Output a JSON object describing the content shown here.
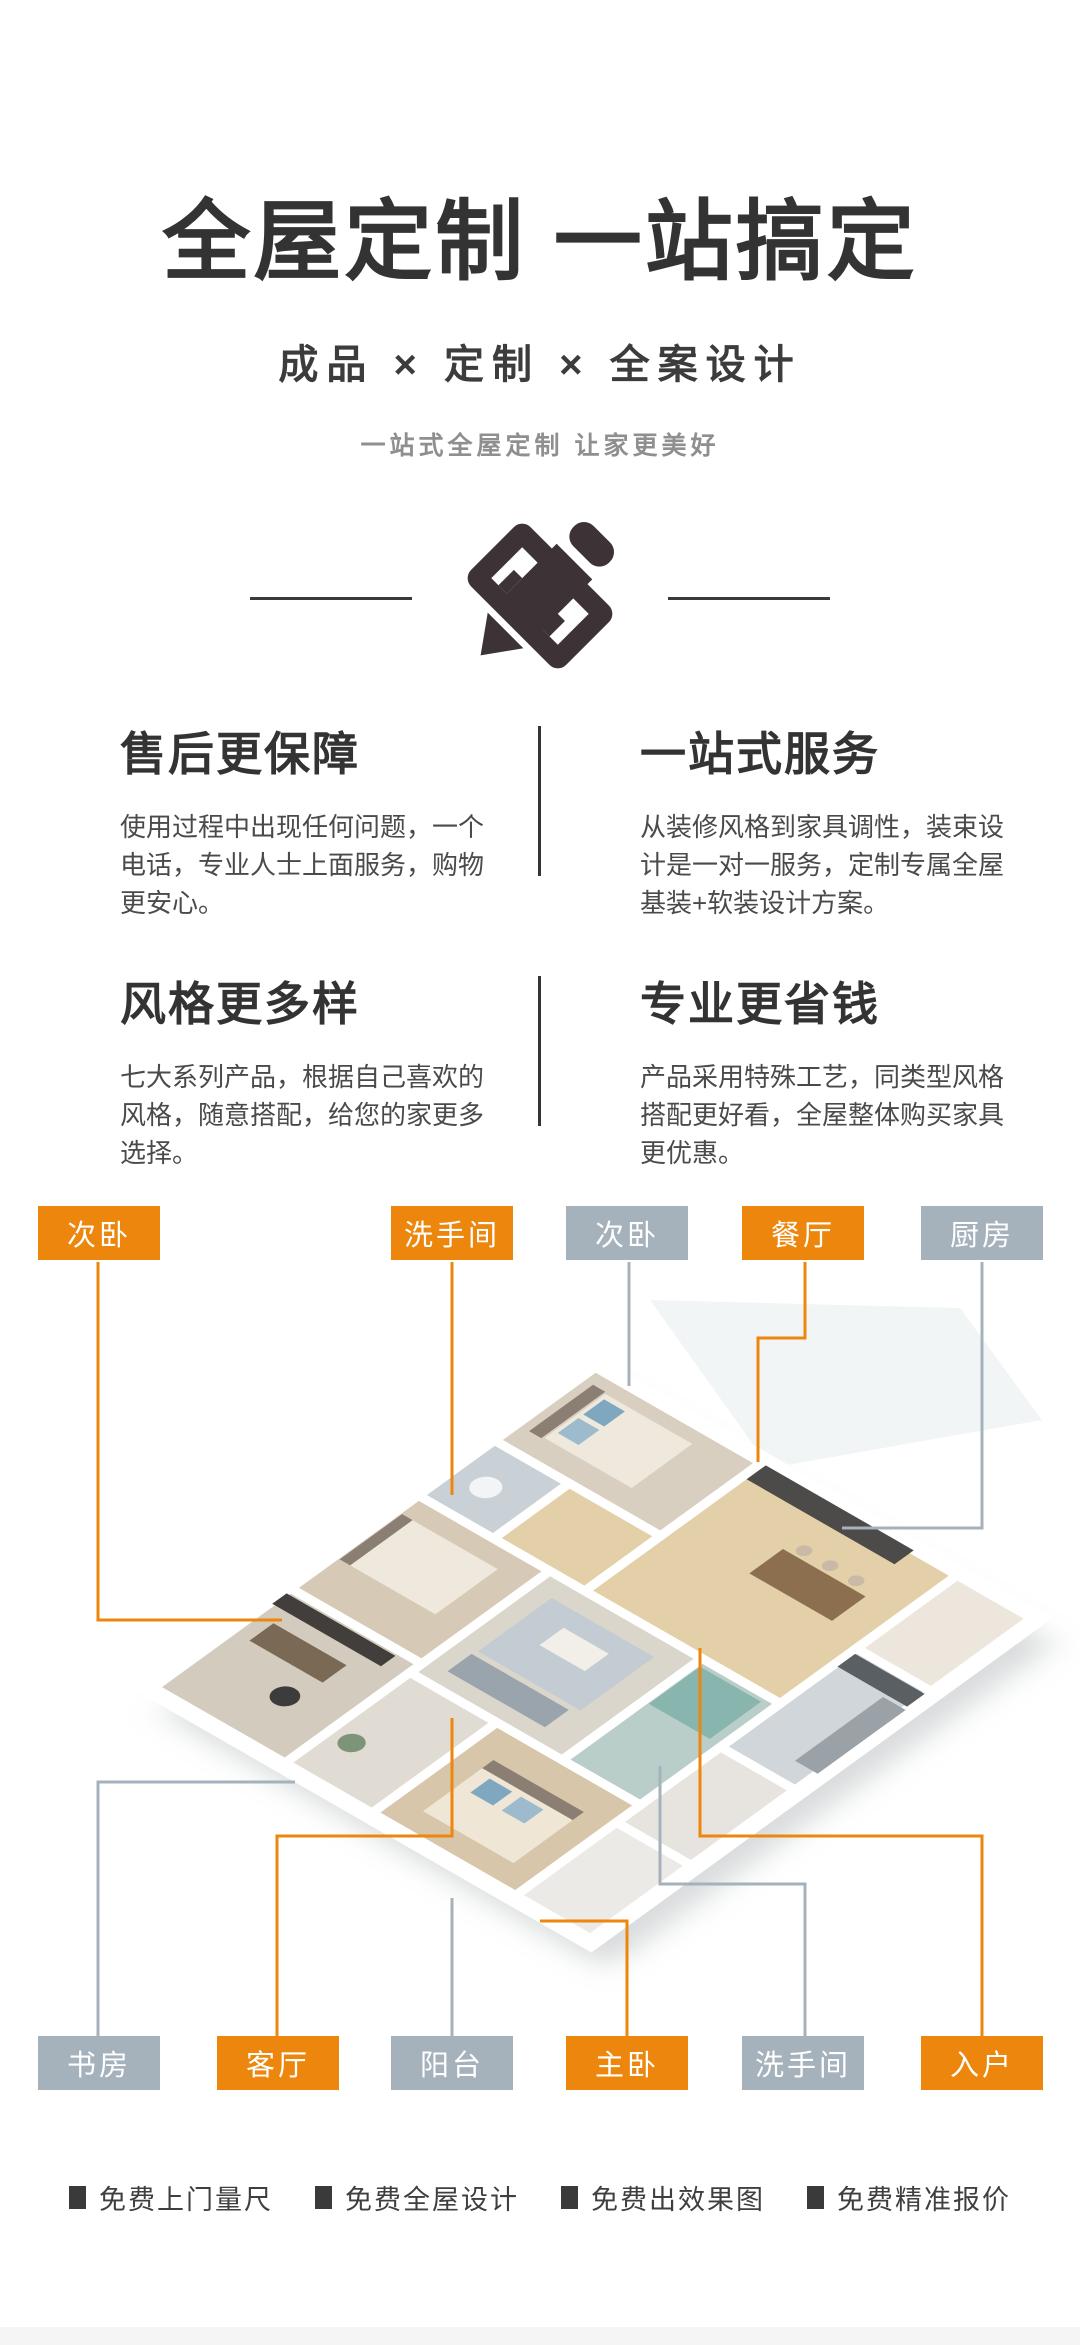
{
  "hero": {
    "title": "全屋定制 一站搞定",
    "subtitle": "成品 × 定制 × 全案设计",
    "tagline": "一站式全屋定制 让家更美好",
    "icon": "pencil-ruler-icon"
  },
  "features": [
    {
      "title": "售后更保障",
      "desc": "使用过程中出现任何问题，一个电话，专业人士上面服务，购物更安心。"
    },
    {
      "title": "一站式服务",
      "desc": "从装修风格到家具调性，装束设计是一对一服务，定制专属全屋基装+软装设计方案。"
    },
    {
      "title": "风格更多样",
      "desc": "七大系列产品，根据自己喜欢的风格，随意搭配，给您的家更多选择。"
    },
    {
      "title": "专业更省钱",
      "desc": "产品采用特殊工艺，同类型风格搭配更好看，全屋整体购买家具更优惠。"
    }
  ],
  "plan": {
    "colors": {
      "orange": "#ED860C",
      "gray": "#A5B2BC"
    },
    "labels_top": [
      {
        "text": "次卧",
        "style": "orange"
      },
      {
        "text": "洗手间",
        "style": "orange"
      },
      {
        "text": "次卧",
        "style": "gray"
      },
      {
        "text": "餐厅",
        "style": "orange"
      },
      {
        "text": "厨房",
        "style": "gray"
      }
    ],
    "labels_bottom": [
      {
        "text": "书房",
        "style": "gray"
      },
      {
        "text": "客厅",
        "style": "orange"
      },
      {
        "text": "阳台",
        "style": "gray"
      },
      {
        "text": "主卧",
        "style": "orange"
      },
      {
        "text": "洗手间",
        "style": "gray"
      },
      {
        "text": "入户",
        "style": "orange"
      }
    ]
  },
  "footer": {
    "items": [
      "免费上门量尺",
      "免费全屋设计",
      "免费出效果图",
      "免费精准报价"
    ]
  }
}
